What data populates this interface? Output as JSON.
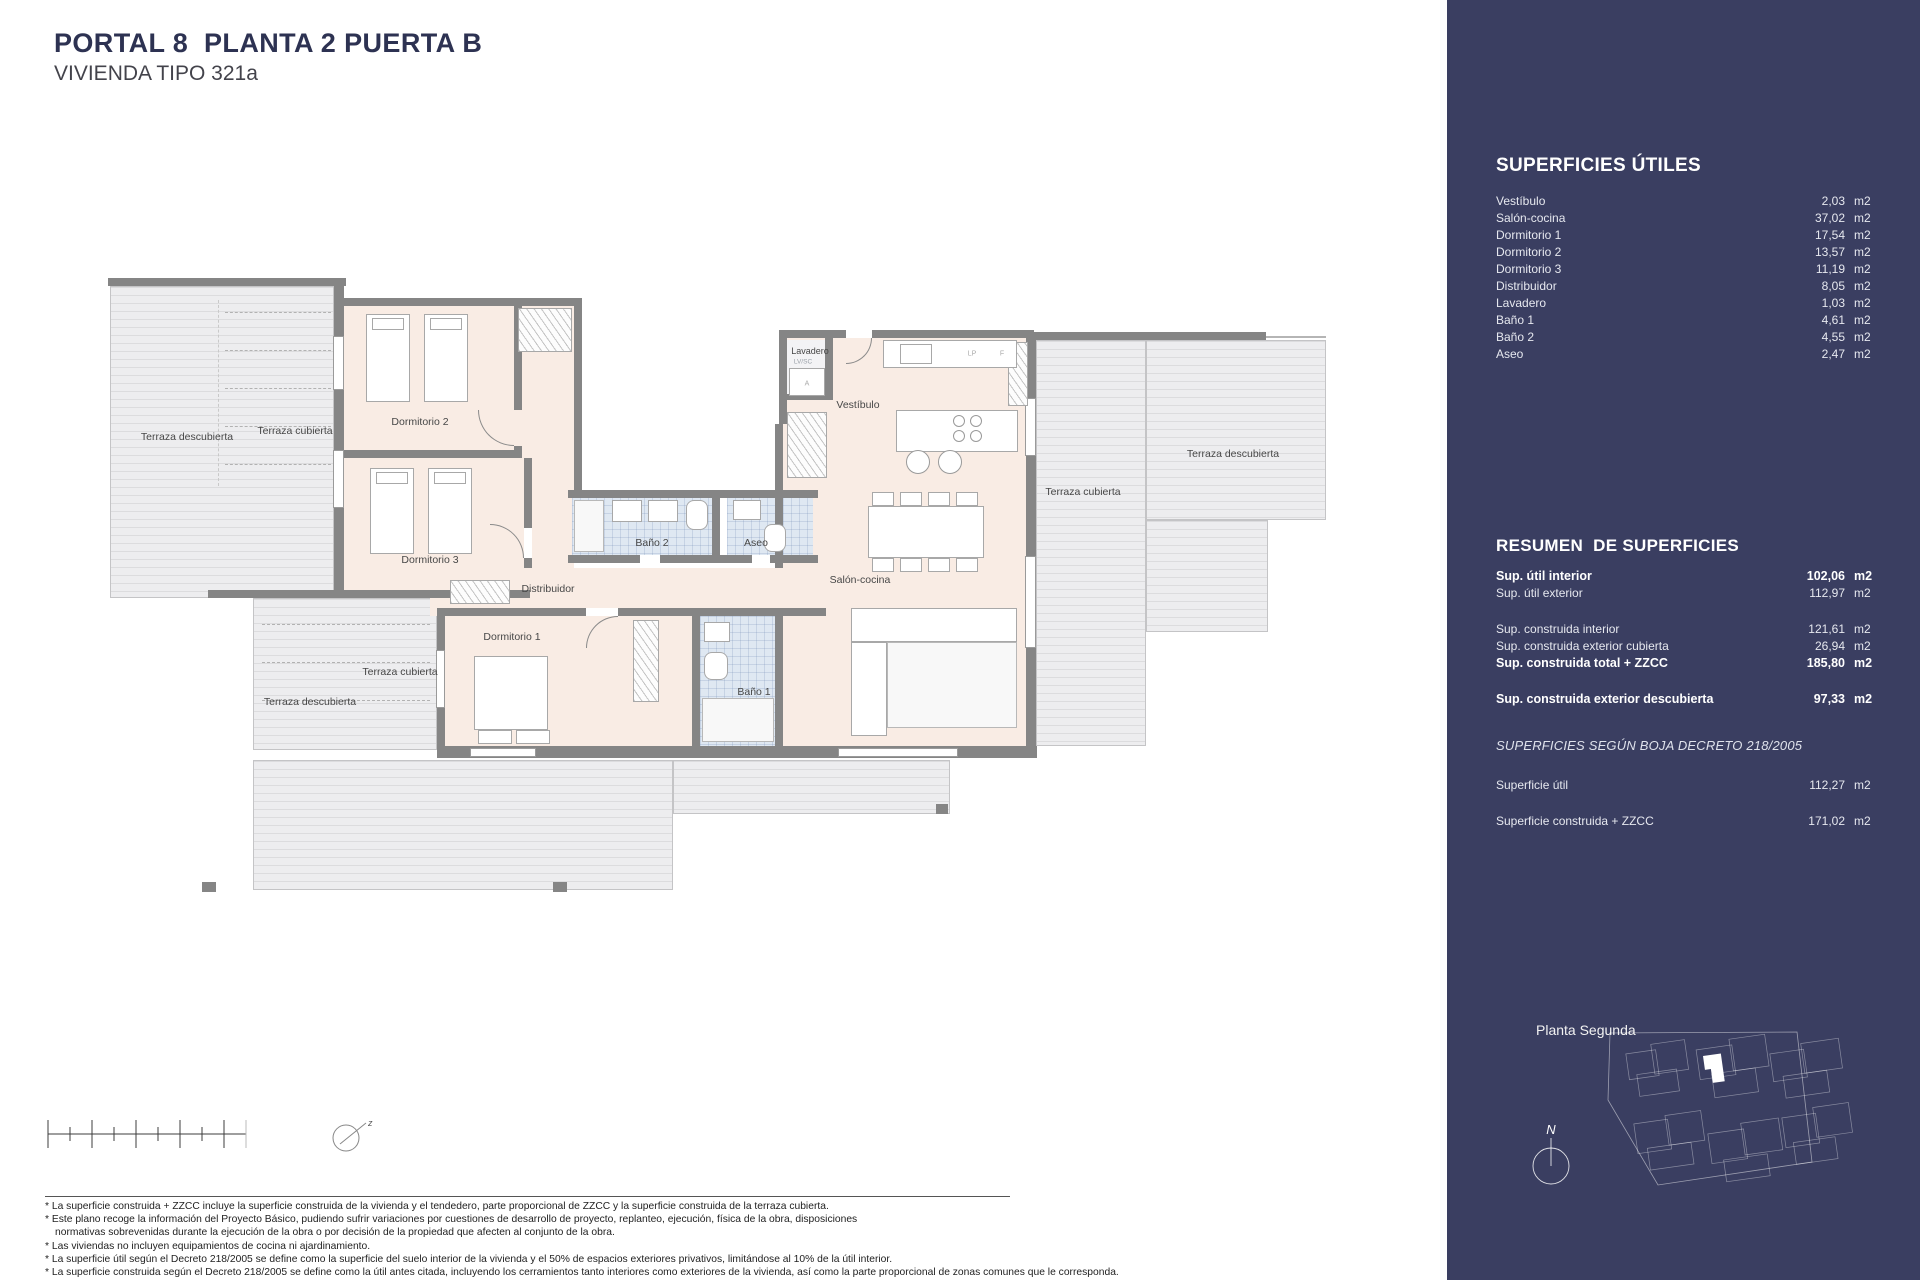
{
  "header": {
    "title": "PORTAL 8  PLANTA 2 PUERTA B",
    "subtitle": "VIVIENDA TIPO 321a"
  },
  "colors": {
    "sidebar_bg": "#3a3e61",
    "wall": "#858585",
    "room_floor": "#f9ece4",
    "terrace_floor": "#ededef",
    "bath_floor": "#dfe8f2"
  },
  "sidebar": {
    "utiles": {
      "title": "SUPERFICIES ÚTILES",
      "rows": [
        {
          "label": "Vestíbulo",
          "value": "2,03",
          "unit": "m2"
        },
        {
          "label": "Salón-cocina",
          "value": "37,02",
          "unit": "m2"
        },
        {
          "label": "Dormitorio 1",
          "value": "17,54",
          "unit": "m2"
        },
        {
          "label": "Dormitorio 2",
          "value": "13,57",
          "unit": "m2"
        },
        {
          "label": "Dormitorio 3",
          "value": "11,19",
          "unit": "m2"
        },
        {
          "label": "Distribuidor",
          "value": "8,05",
          "unit": "m2"
        },
        {
          "label": "Lavadero",
          "value": "1,03",
          "unit": "m2"
        },
        {
          "label": "Baño 1",
          "value": "4,61",
          "unit": "m2"
        },
        {
          "label": "Baño 2",
          "value": "4,55",
          "unit": "m2"
        },
        {
          "label": "Aseo",
          "value": "2,47",
          "unit": "m2"
        }
      ]
    },
    "resumen": {
      "title": "RESUMEN  DE SUPERFICIES",
      "rows": [
        {
          "label": "Sup. útil interior",
          "value": "102,06",
          "unit": "m2",
          "bold": true
        },
        {
          "label": "Sup. útil exterior",
          "value": "112,97",
          "unit": "m2"
        },
        {
          "label": "Sup. construida interior",
          "value": "121,61",
          "unit": "m2",
          "gap": true
        },
        {
          "label": "Sup. construida exterior cubierta",
          "value": "26,94",
          "unit": "m2"
        },
        {
          "label": "Sup. construida total + ZZCC",
          "value": "185,80",
          "unit": "m2",
          "bold": true
        },
        {
          "label": "Sup. construida exterior descubierta",
          "value": "97,33",
          "unit": "m2",
          "bold": true,
          "gap": true
        }
      ]
    },
    "boja": {
      "title": "SUPERFICIES SEGÚN BOJA DECRETO 218/2005",
      "rows": [
        {
          "label": "Superficie útil",
          "value": "112,27",
          "unit": "m2"
        },
        {
          "label": "Superficie construida + ZZCC",
          "value": "171,02",
          "unit": "m2",
          "gap": true
        }
      ]
    },
    "siteplan": {
      "label": "Planta Segunda",
      "north": "N"
    }
  },
  "plan": {
    "compass": "z",
    "labels": [
      {
        "text": "Terraza descubierta",
        "x": 187,
        "y": 437,
        "name": "terrace-left-open-label"
      },
      {
        "text": "Terraza cubierta",
        "x": 295,
        "y": 431,
        "name": "terrace-left-covered-label"
      },
      {
        "text": "Dormitorio 2",
        "x": 420,
        "y": 422,
        "name": "dormitorio2-label"
      },
      {
        "text": "Dormitorio 3",
        "x": 430,
        "y": 560,
        "name": "dormitorio3-label"
      },
      {
        "text": "Distribuidor",
        "x": 548,
        "y": 589,
        "name": "distribuidor-label"
      },
      {
        "text": "Baño 2",
        "x": 652,
        "y": 543,
        "name": "bano2-label"
      },
      {
        "text": "Aseo",
        "x": 756,
        "y": 543,
        "name": "aseo-label"
      },
      {
        "text": "Dormitorio 1",
        "x": 512,
        "y": 637,
        "name": "dormitorio1-label"
      },
      {
        "text": "Baño 1",
        "x": 754,
        "y": 692,
        "name": "bano1-label"
      },
      {
        "text": "Lavadero",
        "x": 810,
        "y": 351,
        "size": 9,
        "name": "lavadero-label"
      },
      {
        "text": "LV/SC",
        "x": 803,
        "y": 362,
        "size": 6.5,
        "color": "#9aa0a8",
        "name": "lavadero-sub-label"
      },
      {
        "text": "Vestíbulo",
        "x": 858,
        "y": 405,
        "name": "vestibulo-label"
      },
      {
        "text": "Salón-cocina",
        "x": 860,
        "y": 580,
        "name": "salon-cocina-label"
      },
      {
        "text": "Terraza cubierta",
        "x": 1083,
        "y": 492,
        "name": "terrace-right-covered-label"
      },
      {
        "text": "Terraza descubierta",
        "x": 1233,
        "y": 454,
        "name": "terrace-right-open-label"
      },
      {
        "text": "Terraza cubierta",
        "x": 400,
        "y": 672,
        "name": "terrace-bottom-covered-label"
      },
      {
        "text": "Terraza descubierta",
        "x": 310,
        "y": 702,
        "name": "terrace-bottom-open-label"
      },
      {
        "text": "LP",
        "x": 972,
        "y": 354,
        "size": 7,
        "color": "#aaaaaa",
        "name": "kitchen-lp-label"
      },
      {
        "text": "F",
        "x": 1002,
        "y": 354,
        "size": 7,
        "color": "#aaaaaa",
        "name": "kitchen-f-label"
      },
      {
        "text": "A",
        "x": 807,
        "y": 384,
        "size": 7,
        "color": "#aaaaaa",
        "name": "lavadero-a-label"
      }
    ]
  },
  "footnotes": [
    {
      "text": "* La superficie construida + ZZCC incluye la superficie construida de la vivienda y el tendedero, parte proporcional de ZZCC y la superficie construida de la terraza cubierta."
    },
    {
      "text": "* Este plano recoge la información del Proyecto Básico, pudiendo sufrir variaciones por cuestiones de desarrollo de proyecto, replanteo, ejecución, física de la obra, disposiciones"
    },
    {
      "text": "normativas sobrevenidas durante la ejecución de la obra o por decisión de la propiedad que afecten al conjunto de la obra.",
      "indent": true
    },
    {
      "text": "* Las viviendas no incluyen equipamientos de cocina ni ajardinamiento."
    },
    {
      "text": "* La superficie útil según el Decreto 218/2005 se define como la superficie del suelo interior de la vivienda y el 50% de espacios exteriores privativos, limitándose al 10% de la útil interior."
    },
    {
      "text": "* La superficie construida según el Decreto 218/2005 se define como la útil antes citada, incluyendo los cerramientos tanto interiores como exteriores de la vivienda, así como la parte proporcional de zonas comunes que le corresponda."
    }
  ]
}
